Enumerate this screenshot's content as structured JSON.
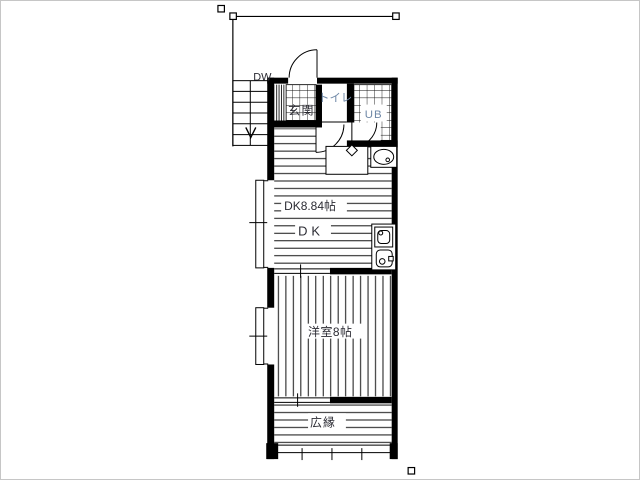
{
  "window": {
    "background": "#ffffff",
    "border_color": "#c6c6c6"
  },
  "floor_plan": {
    "labels": {
      "dw": "DW",
      "entrance": "玄関",
      "toilet": "トイレ",
      "unit_bath": "UB",
      "dk_area": "DK8.84帖",
      "dk": "DK",
      "western_room": "洋室8帖",
      "veranda": "広縁"
    },
    "colors": {
      "wall": "#000000",
      "line": "#111111",
      "label_dark": "#2b2b33",
      "label_accent": "#6f88a7"
    },
    "icons": [
      "stairs-down-arrow-icon",
      "door-swing-arc",
      "sink-faucet-icon",
      "wash-basin-icon",
      "stove-icon",
      "water-heater-icon",
      "window-tick-mark"
    ]
  },
  "selection": {
    "handle_count": 4
  }
}
